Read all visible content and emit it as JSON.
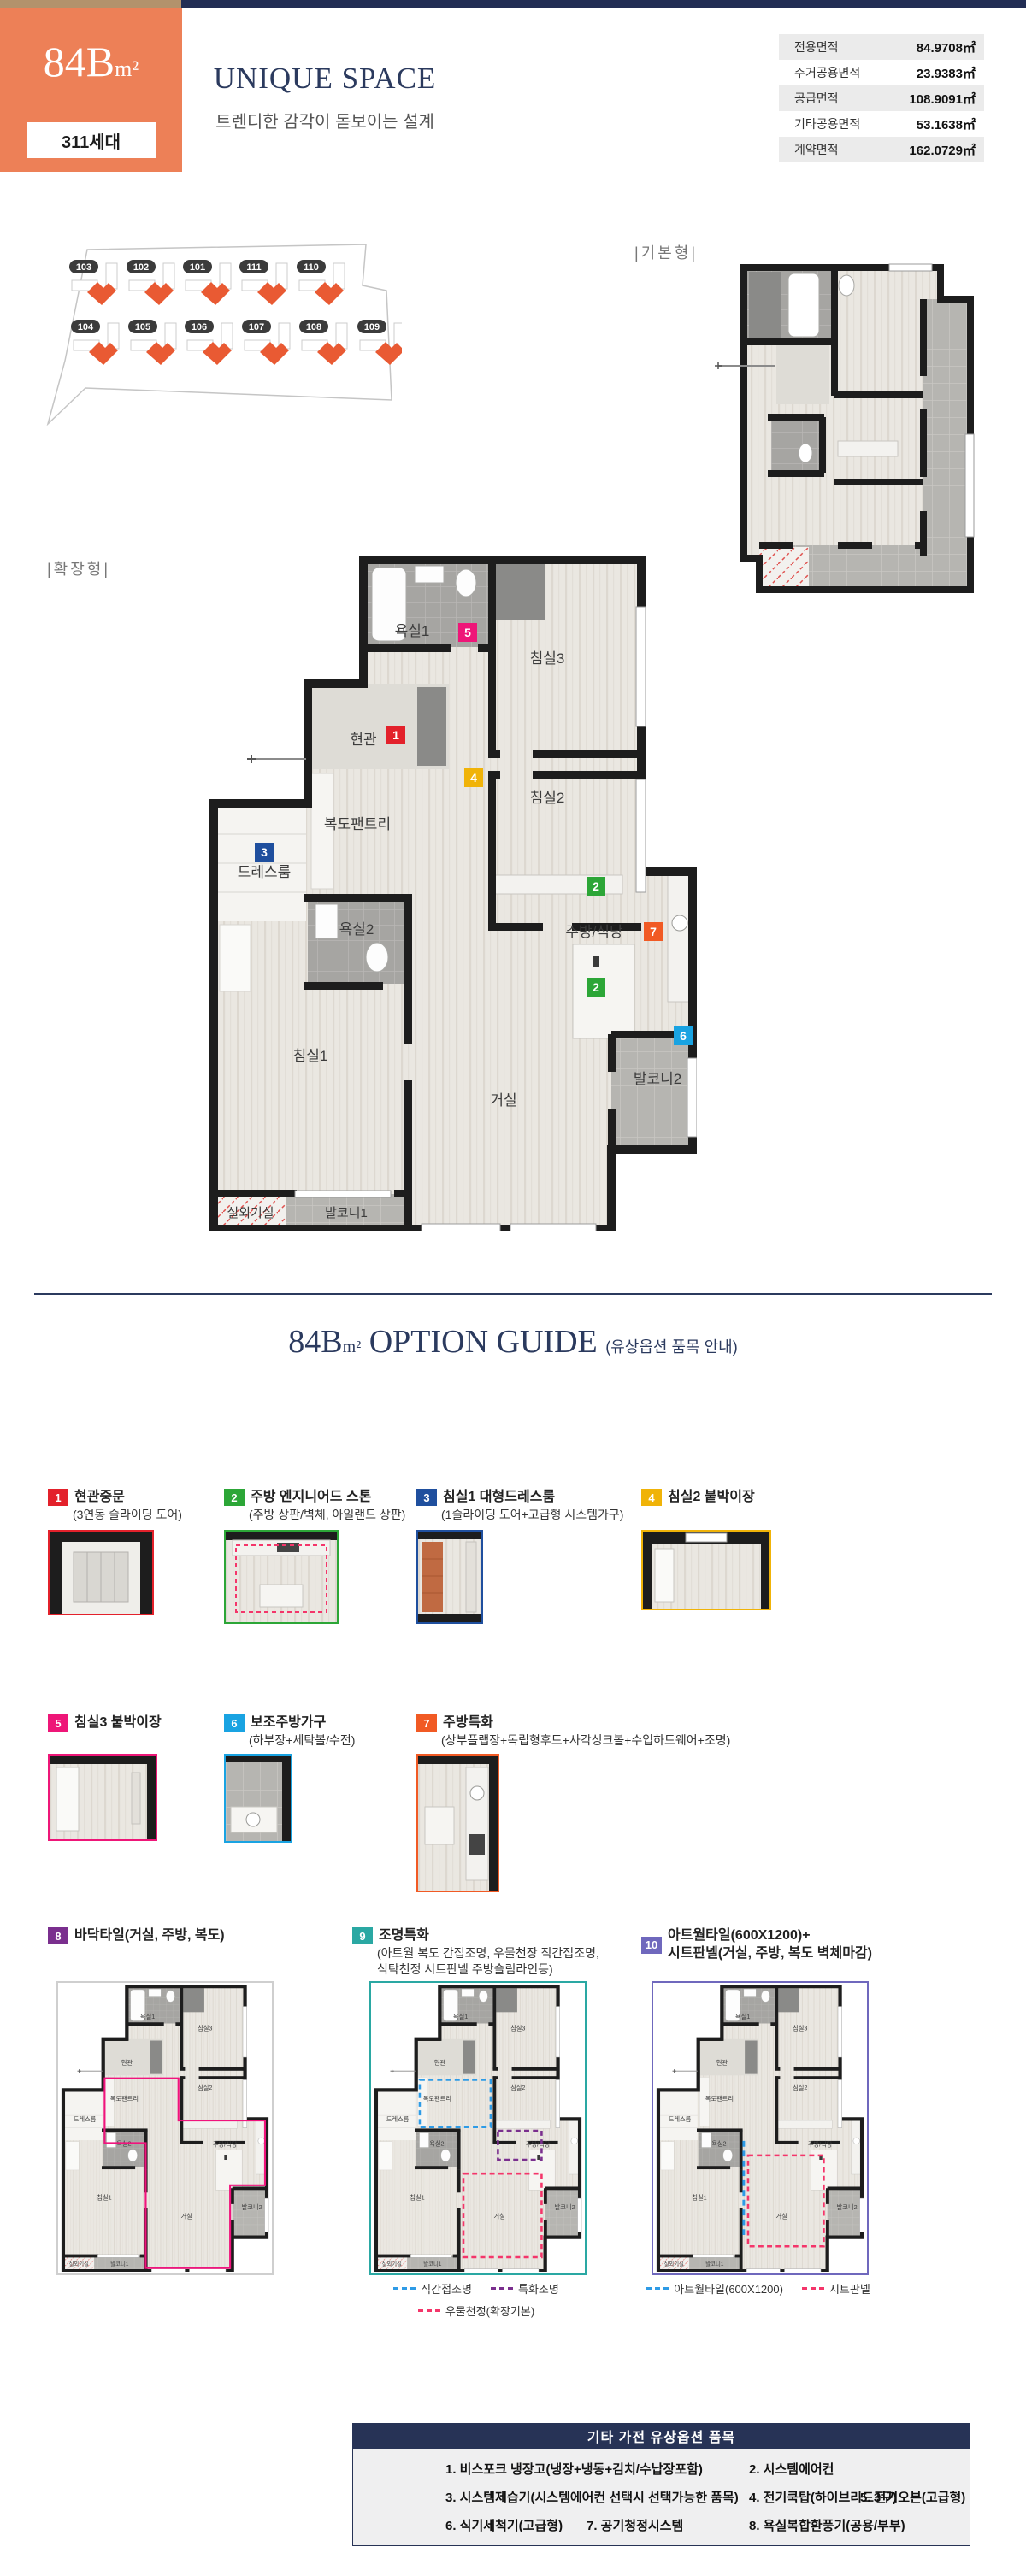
{
  "header": {
    "unit": "84B",
    "unit_sup": "m²",
    "households": "311세대",
    "title": "UNIQUE SPACE",
    "subtitle": "트렌디한 감각이 돋보이는 설계"
  },
  "area_table": {
    "rows": [
      {
        "label": "전용면적",
        "value": "84.9708㎡"
      },
      {
        "label": "주거공용면적",
        "value": "23.9383㎡"
      },
      {
        "label": "공급면적",
        "value": "108.9091㎡"
      },
      {
        "label": "기타공용면적",
        "value": "53.1638㎡"
      },
      {
        "label": "계약면적",
        "value": "162.0729㎡"
      }
    ]
  },
  "site_plan": {
    "top_row": [
      "103",
      "102",
      "101",
      "111",
      "110"
    ],
    "bottom_row": [
      "104",
      "105",
      "106",
      "107",
      "108",
      "109"
    ],
    "unit_color": "#e95a33"
  },
  "plans": {
    "basic_label": "|기본형|",
    "extended_label": "|확장형|",
    "rooms": {
      "bath1": "욕실1",
      "entry": "현관",
      "pantry": "복도팬트리",
      "dress": "드레스룸",
      "bath2": "욕실2",
      "bed1": "침실1",
      "bed2": "침실2",
      "bed3": "침실3",
      "kitchen": "주방/식당",
      "living": "거실",
      "balcony1": "발코니1",
      "balcony2": "발코니2",
      "outdoor": "실외기실"
    },
    "badges": [
      {
        "num": "1",
        "color": "#e3212b"
      },
      {
        "num": "2",
        "color": "#2ca637"
      },
      {
        "num": "2",
        "color": "#2ca637"
      },
      {
        "num": "3",
        "color": "#1f4f9e"
      },
      {
        "num": "4",
        "color": "#f0b308"
      },
      {
        "num": "5",
        "color": "#ee1678"
      },
      {
        "num": "6",
        "color": "#19a3e2"
      },
      {
        "num": "7",
        "color": "#f15a24"
      }
    ]
  },
  "option_guide": {
    "title_unit": "84B",
    "title_sup": "m²",
    "title_main": " OPTION GUIDE ",
    "title_note": "(유상옵션 품목 안내)"
  },
  "options": [
    {
      "num": "1",
      "color": "#e3212b",
      "title": "현관중문",
      "desc": "(3연동 슬라이딩 도어)"
    },
    {
      "num": "2",
      "color": "#2ca637",
      "title": "주방 엔지니어드 스톤",
      "desc": "(주방 상판/벽체, 아일랜드 상판)"
    },
    {
      "num": "3",
      "color": "#1f4f9e",
      "title": "침실1 대형드레스룸",
      "desc": "(1슬라이딩 도어+고급형 시스템가구)"
    },
    {
      "num": "4",
      "color": "#f0b308",
      "title": "침실2 붙박이장",
      "desc": ""
    },
    {
      "num": "5",
      "color": "#ee1678",
      "title": "침실3 붙박이장",
      "desc": ""
    },
    {
      "num": "6",
      "color": "#19a3e2",
      "title": "보조주방가구",
      "desc": "(하부장+세탁볼/수전)"
    },
    {
      "num": "7",
      "color": "#f15a24",
      "title": "주방특화",
      "desc": "(상부플랩장+독립형후드+사각싱크볼+수입하드웨어+조명)"
    },
    {
      "num": "8",
      "color": "#7a2f8e",
      "title": "바닥타일(거실, 주방, 복도)",
      "desc": ""
    },
    {
      "num": "9",
      "color": "#2aa8a3",
      "title": "조명특화",
      "desc": "(아트월 복도 간접조명, 우물천장 직간접조명,\n식탁천정 시트판넬 주방슬림라인등)"
    },
    {
      "num": "10",
      "color": "#6f68bd",
      "title": "아트월타일(600X1200)+\n시트판넬(거실, 주방, 복도 벽체마감)",
      "desc": ""
    }
  ],
  "legends": {
    "lighting": [
      {
        "label": "직간접조명",
        "color": "#2e9be6"
      },
      {
        "label": "특화조명",
        "color": "#7a2f8e"
      },
      {
        "label": "우물천정(확장기본)",
        "color": "#f4356a"
      }
    ],
    "artwall": [
      {
        "label": "아트월타일(600X1200)",
        "color": "#2e9be6"
      },
      {
        "label": "시트판넬",
        "color": "#f4356a"
      }
    ]
  },
  "etc_table": {
    "title": "기타 가전 유상옵션 품목",
    "row1": [
      "1. 비스포크 냉장고(냉장+냉동+김치/수납장포함)",
      "2. 시스템에어컨"
    ],
    "row2": [
      "3. 시스템제습기(시스템에어컨 선택시 선택가능한 품목)",
      "4. 전기쿡탑(하이브리드3구)",
      "5. 전기오븐(고급형)"
    ],
    "row3": [
      "6. 식기세척기(고급형)",
      "7. 공기청정시스템",
      "8. 욕실복합환풍기(공용/부부)"
    ]
  },
  "colors": {
    "navy": "#273356",
    "orange_box": "#ed8057",
    "tan": "#b3926c"
  }
}
